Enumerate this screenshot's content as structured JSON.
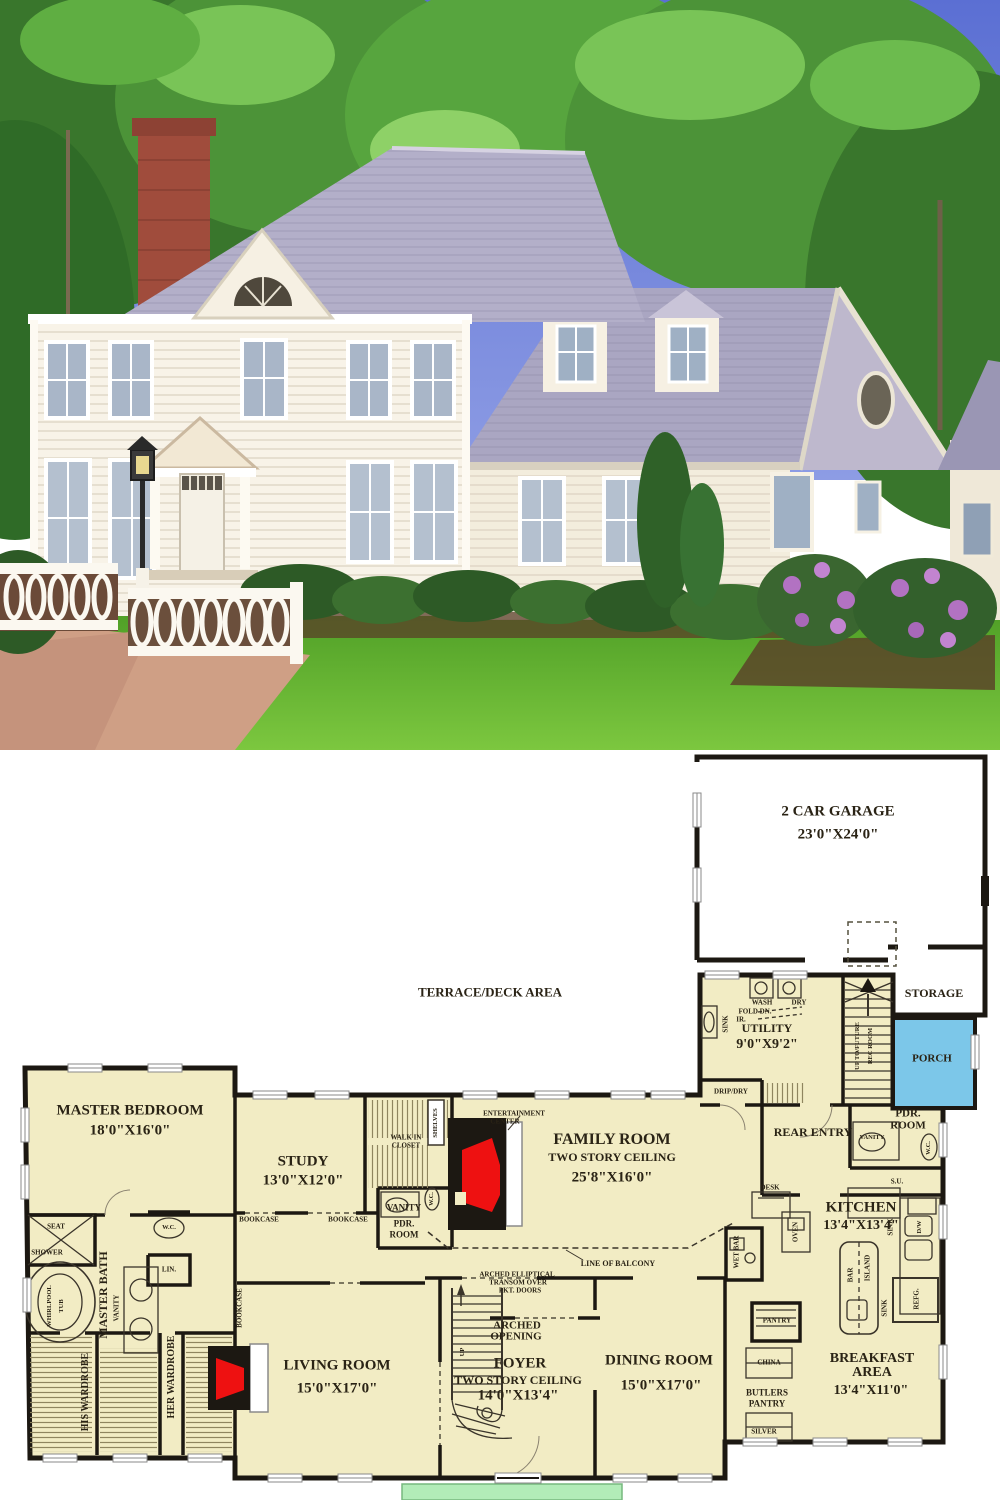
{
  "palette": {
    "plan_floor": "#f2ecc4",
    "plan_wall": "#1c1812",
    "porch_fill": "#7cc7e9",
    "stoop_fill": "#b2ecb8",
    "fireplace_red": "#ee1111",
    "sky_blue": "#6277d8",
    "tree_green": "#4c9338",
    "roof_gray": "#aaa6c2",
    "house_white": "#f8f3e8",
    "lawn_green": "#58a52c",
    "chimney_brick": "#a04c3c",
    "flower_purple": "#b272c2"
  },
  "plan": {
    "terrace_label": "TERRACE/DECK AREA",
    "rooms": {
      "garage": {
        "name": "2 CAR GARAGE",
        "dims": "23'0\"X24'0\""
      },
      "storage": {
        "name": "STORAGE"
      },
      "porch": {
        "name": "PORCH"
      },
      "utility": {
        "name": "UTILITY",
        "dims": "9'0\"X9'2\""
      },
      "master_bedroom": {
        "name": "MASTER BEDROOM",
        "dims": "18'0\"X16'0\""
      },
      "study": {
        "name": "STUDY",
        "dims": "13'0\"X12'0\""
      },
      "family_room": {
        "name": "FAMILY ROOM",
        "note": "TWO STORY CEILING",
        "dims": "25'8\"X16'0\""
      },
      "rear_entry": {
        "name": "REAR ENTRY"
      },
      "kitchen": {
        "name": "KITCHEN",
        "dims": "13'4\"X13'4\""
      },
      "master_bath": {
        "name": "MASTER BATH"
      },
      "pdr": {
        "name1": "PDR.",
        "name2": "ROOM"
      },
      "living_room": {
        "name": "LIVING ROOM",
        "dims": "15'0\"X17'0\""
      },
      "foyer": {
        "name": "FOYER",
        "note": "TWO STORY CEILING",
        "dims": "14'0\"X13'4\""
      },
      "dining_room": {
        "name": "DINING ROOM",
        "dims": "15'0\"X17'0\""
      },
      "breakfast": {
        "name1": "BREAKFAST",
        "name2": "AREA",
        "dims": "13'4\"X11'0\""
      }
    },
    "fixtures": {
      "wash": "WASH",
      "dry": "DRY",
      "fold_dn": "FOLD DN.",
      "ir": "IR.",
      "sink": "SINK",
      "drip_dry": "DRIP/DRY",
      "up_to_future": "UP TO/FUTURE",
      "rec_room": "REC ROOM",
      "up": "UP",
      "walk_in": "WALK IN",
      "closet": "CLOSET",
      "shelves": "SHELVES",
      "entertainment": "ENTERTAINMENT",
      "center": "CENTER",
      "bookcase": "BOOKCASE",
      "vanity": "VANITY",
      "wc": "W.C.",
      "lin": "LIN.",
      "seat": "SEAT",
      "shower": "SHOWER",
      "whirlpool": "WHIRLPOOL",
      "tub": "TUB",
      "his_wardrobe": "HIS WARDROBE",
      "her_wardrobe": "HER WARDROBE",
      "desk": "DESK",
      "oven": "OVEN",
      "wet_bar": "WET BAR",
      "su": "S.U.",
      "dw": "D/W",
      "bar": "BAR",
      "island": "ISLAND",
      "refg": "REFG.",
      "pantry": "PANTRY",
      "china": "CHINA",
      "butlers": "BUTLERS",
      "butlers_pantry": "PANTRY",
      "silver": "SILVER",
      "arched1": "ARCHED",
      "arched2": "OPENING",
      "transom1": "ARCHED ELLIPTICAL",
      "transom2": "TRANSOM OVER",
      "transom3": "PKT. DOORS",
      "balcony": "LINE OF BALCONY"
    }
  }
}
